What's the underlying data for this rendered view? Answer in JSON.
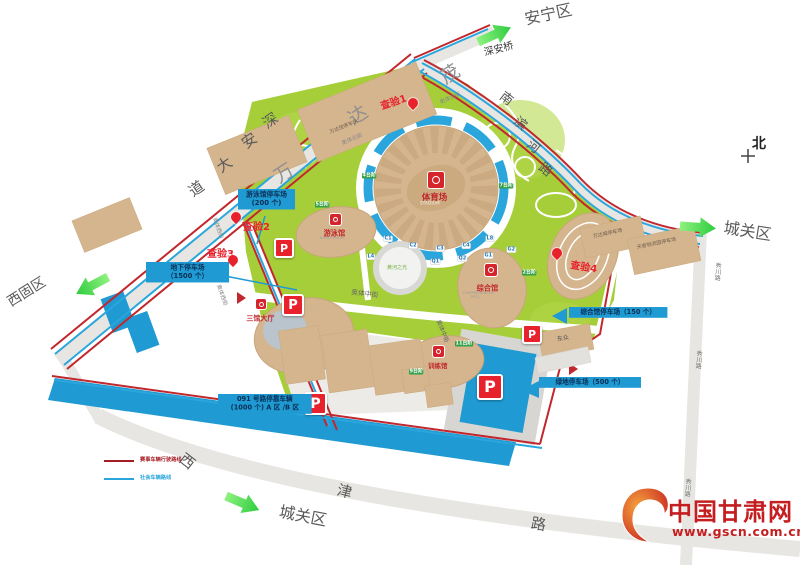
{
  "regions": {
    "anning": "安宁区",
    "chengguan_right": "城关区",
    "chengguan_bottom": "城关区",
    "xigu": "西固区"
  },
  "compass": {
    "north": "北"
  },
  "roads": {
    "shenan_dadao": "深安大道",
    "shenan_bridge": "深安桥",
    "nanbinhe_road": "南滨河路",
    "xiuchuan_road": "秀川路",
    "xijin_road": "西津路",
    "aoti_middle_st": "奥体中街",
    "aoti_west_st": "奥体西街",
    "aoti_north_st": "奥体北街",
    "wanda_mall": "万达茂"
  },
  "checkpoints": {
    "c1": "查验1",
    "c2": "查验2",
    "c3": "查验3",
    "c4": "查验4"
  },
  "parking_labels": {
    "natatorium_lot_line1": "游泳馆停车场",
    "natatorium_lot_line2": "(200 个)",
    "underground_lot_line1": "地下停车场",
    "underground_lot_line2": "（1500 个）",
    "comprehensive_lot": "综合馆停车场（150 个）",
    "green_lot": "绿地停车场（500 个）",
    "road091_line1": "091 号路停靠车辆",
    "road091_line2": "(1000 个) A 区 /B 区",
    "p": "P"
  },
  "venues": {
    "stadium": {
      "name": "体育场",
      "caption": "STADIUM"
    },
    "natatorium": {
      "name": "游泳馆",
      "caption": "NATATORIUM"
    },
    "comprehensive_hall": {
      "name": "综合馆",
      "caption": "COMPREHENSIVE HALL"
    },
    "three_hall_lobby": {
      "name": "三馆大厅"
    },
    "training_hall": {
      "name": "训练馆"
    },
    "sculpture": {
      "name": "黄河之光"
    },
    "dongzhong": {
      "name": "东众"
    },
    "wanda_mall_lot": {
      "name": "万达茂停车场"
    },
    "wanda_city_lot": {
      "name": "万达城停车场"
    },
    "tianqi_lot": {
      "name": "天奇物流园停车场"
    }
  },
  "gate_tags": [
    "C1",
    "C2",
    "C3",
    "C4",
    "L4",
    "L8",
    "Q1",
    "Q2",
    "G1",
    "G2"
  ],
  "step_tags": [
    "4台阶",
    "5台阶",
    "7台阶",
    "2台阶",
    "11台阶",
    "9台阶"
  ],
  "legend": {
    "red": "赛事车辆行驶路线",
    "blue": "社会车辆路线"
  },
  "logo": {
    "name": "中国甘肃网",
    "url": "www.gscn.com.cn"
  },
  "colors": {
    "route_red": "#c1272d",
    "route_blue": "#2aa6dc",
    "parking_blue": "#1f9ad2",
    "site_green": "#a6ce39",
    "building_tan": "#d5b58e",
    "arrow_green": "#3ed357",
    "checkpoint_red": "#e8222d",
    "logo_red": "#c41e20"
  }
}
